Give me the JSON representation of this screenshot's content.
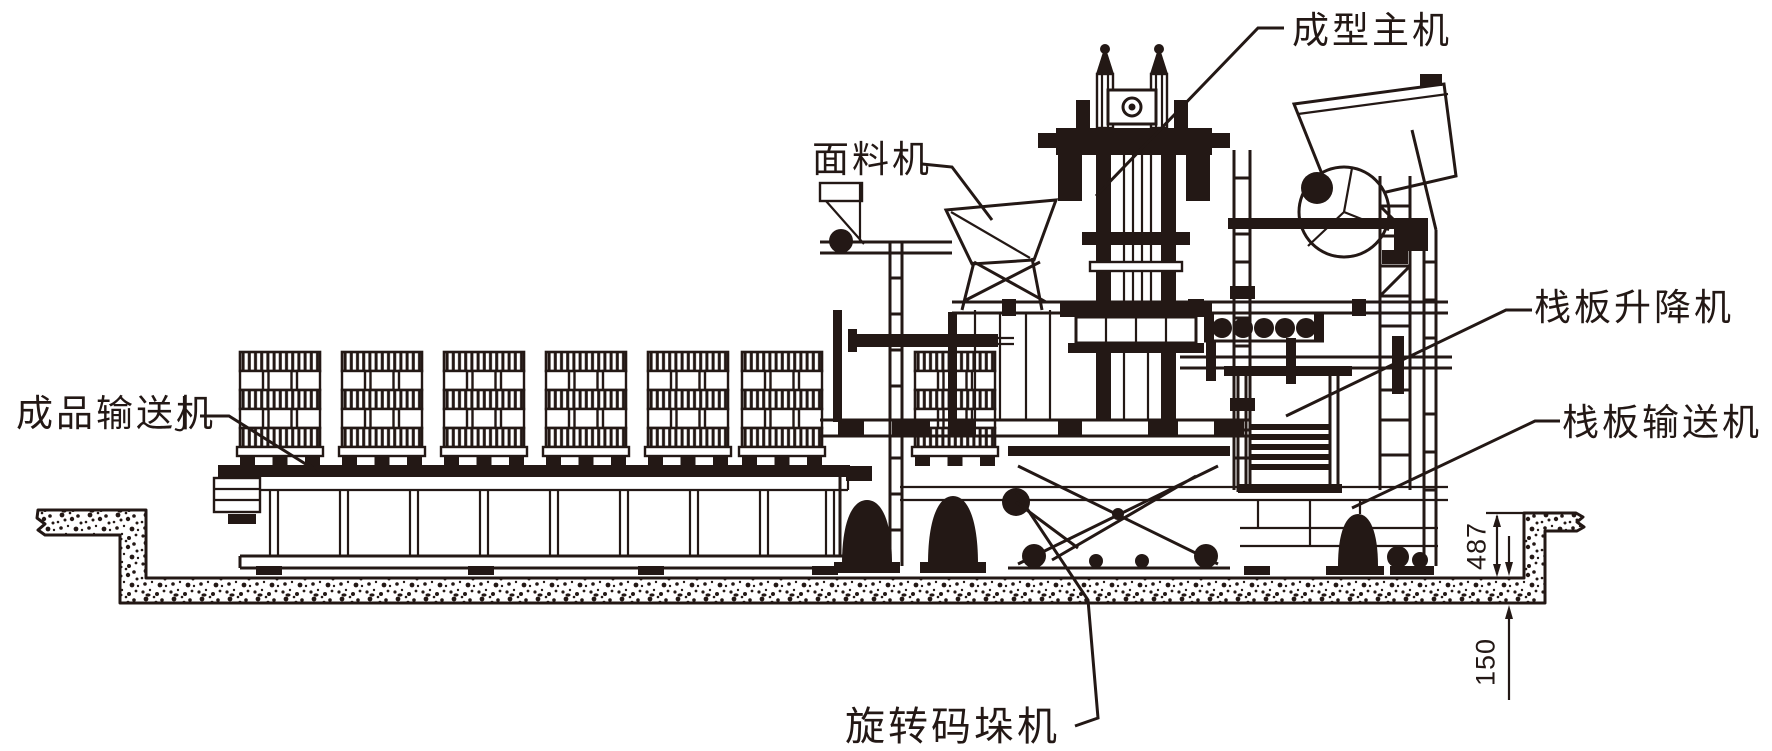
{
  "labels": {
    "forming_machine": "成型主机",
    "face_material_machine": "面料机",
    "pallet_elevator": "栈板升降机",
    "pallet_conveyor": "栈板输送机",
    "finished_product_conveyor": "成品输送机",
    "rotary_palletizer": "旋转码垛机"
  },
  "dimensions": {
    "pit_depth": "487",
    "floor_slab_thickness": "150"
  },
  "colors": {
    "ink": "#231815",
    "paper": "#ffffff"
  }
}
